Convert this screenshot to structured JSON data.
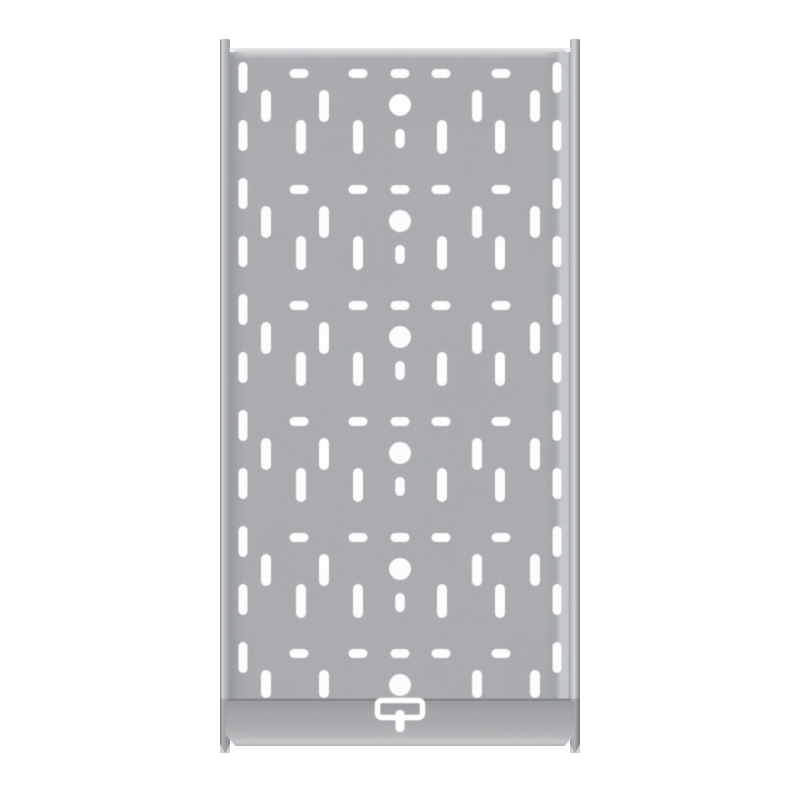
{
  "image": {
    "label": "galvanized perforated cable tray, top view",
    "background": "#ffffff",
    "width": 800,
    "height": 800
  },
  "colors": {
    "hole_white": "#ffffff",
    "panel_base": "#a9abae",
    "panel_top_highlight": "#e9ebec",
    "panel_left_shadow": "#8f9296",
    "panel_right_shadow": "#989b9e",
    "panel_right_light": "#c9cbcd",
    "panel_right_edge": "#9aa0a3",
    "rail_dark_edge": "#7d8084",
    "rail_light": "#d2d4d6",
    "rail_mid": "#b4b6b9",
    "rail_inner": "#9a9da0",
    "rail_below_shade": "#5a5e62",
    "seam_dark": "#7f8285",
    "plate_top": "#97999c",
    "plate_upper": "#a0a2a5",
    "plate_mid": "#a8aaad",
    "plate_lower": "#b4b6b8",
    "plate_bottom_light": "#c6c8ca",
    "plate_bottom_edge": "#b2b4b6"
  },
  "tray": {
    "panel": {
      "x": 229.5,
      "y": 48,
      "w": 341,
      "h": 653,
      "chamfer": 8
    },
    "rails": {
      "left": {
        "x": 220,
        "w": 10
      },
      "right": {
        "x": 570,
        "w": 10
      },
      "top": 39,
      "bottom": 744,
      "tip": 753
    },
    "seam": {
      "x": 229.5,
      "y": 698.5,
      "w": 341,
      "h": 2.6
    },
    "end_plate": {
      "x": 225.5,
      "w": 349,
      "top": 701,
      "bottom": 746,
      "chamfer_y": 735,
      "chamfer_x": 10
    },
    "bracket": {
      "ring": {
        "x": 377.5,
        "y": 700.5,
        "w": 45,
        "h": 17,
        "rx": 4,
        "stroke_w": 5.5
      },
      "stem": {
        "x": 395.5,
        "y": 710,
        "w": 9,
        "h": 22,
        "rx": 4
      }
    },
    "pattern": {
      "period": 116,
      "units": 6,
      "cut_y": 698,
      "dash_row": {
        "y": 69,
        "h": 9,
        "w": 19,
        "centers": [
          299,
          358,
          400,
          441,
          501
        ]
      },
      "slots_a": {
        "y": 90,
        "h": 32,
        "w": 10,
        "centers": [
          266,
          324,
          477,
          535
        ]
      },
      "circle": {
        "cx": 400,
        "cy": 105,
        "r": 11
      },
      "slots_b": {
        "y": 120,
        "h": 34,
        "w": 10,
        "centers": [
          301,
          358,
          442,
          500
        ]
      },
      "center_slot": {
        "y": 129,
        "h": 19,
        "w": 9.5,
        "cx": 400
      },
      "edge_columns": {
        "centers": [
          243,
          557
        ],
        "w": 9,
        "h": 31,
        "y0": 62,
        "step": 58,
        "count": 11
      }
    }
  }
}
